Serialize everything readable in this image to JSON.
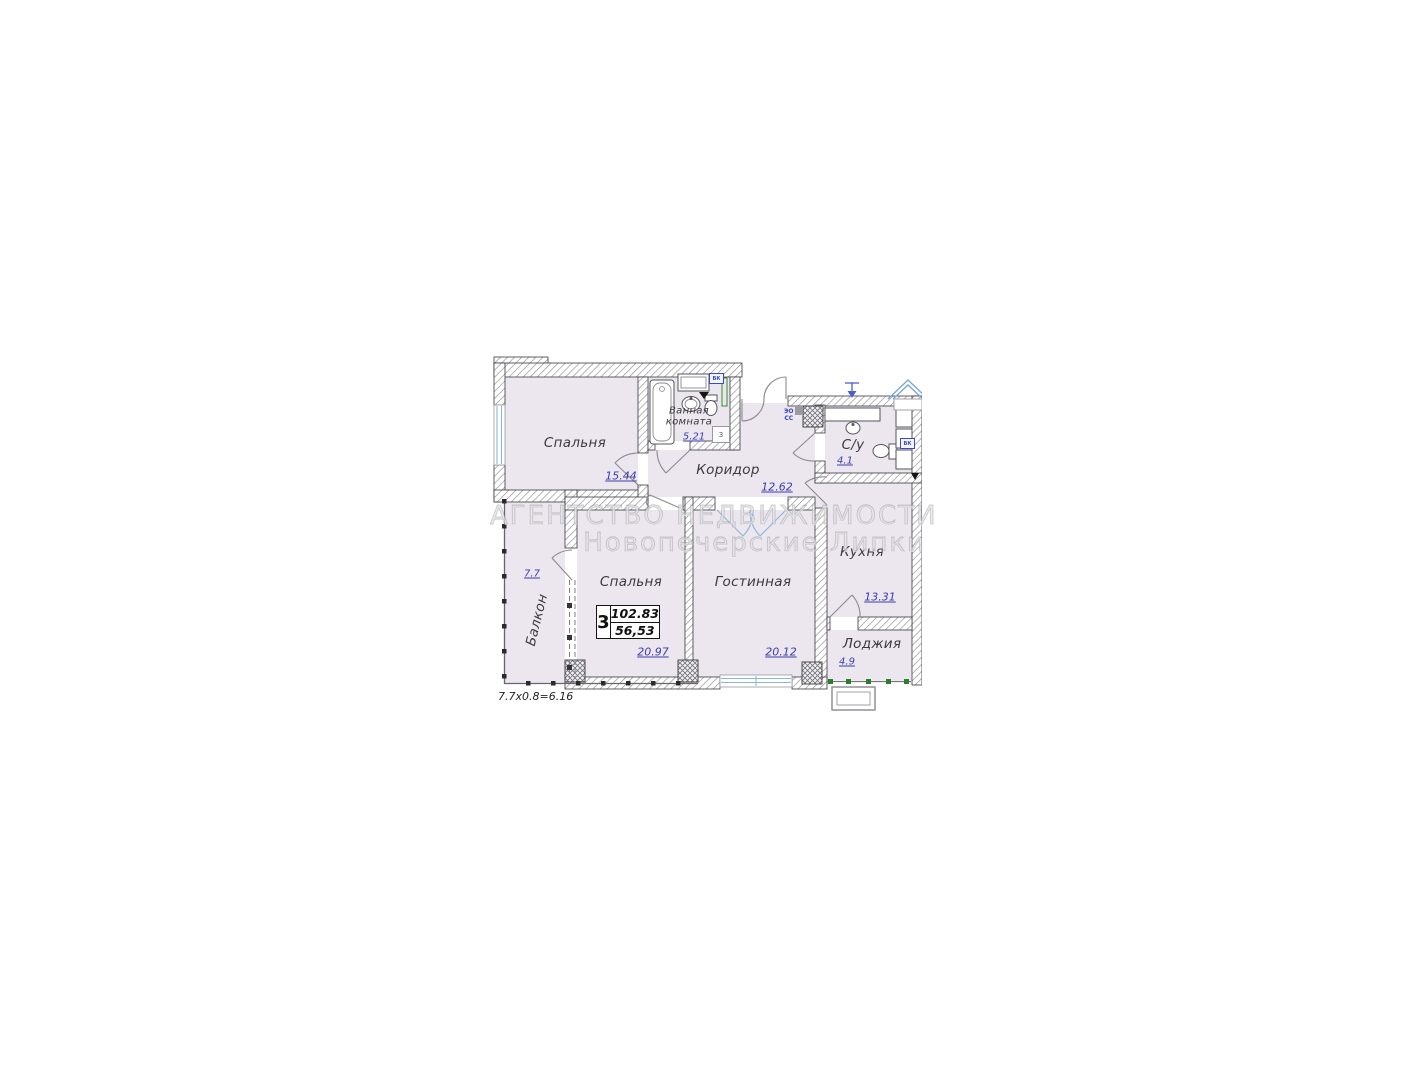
{
  "watermark": {
    "line1": "АГЕНТСТВО НЕДВИЖИМОСТИ",
    "line2": "Новопечерские Липки"
  },
  "info_box": {
    "rooms_count": "3",
    "area_total": "102.83",
    "area_living": "56,53"
  },
  "rooms": {
    "bedroom_top": {
      "label": "Спальня",
      "area": "15.44"
    },
    "bathroom": {
      "label_line1": "Ванная",
      "label_line2": "комната",
      "area": "5.21",
      "marker": "3"
    },
    "corridor": {
      "label": "Коридор",
      "area": "12.62"
    },
    "wc": {
      "label": "С/у",
      "area": "4.1"
    },
    "kitchen": {
      "label": "Кухня",
      "area": "13.31"
    },
    "loggia": {
      "label": "Лоджия",
      "area": "4.9"
    },
    "bedroom_main": {
      "label": "Спальня",
      "area": "20.97"
    },
    "living_room": {
      "label": "Гостинная",
      "area": "20.12"
    },
    "balcony": {
      "label": "Балкон",
      "area": "7.7"
    }
  },
  "notes": {
    "balcony_calc": "7.7x0.8=6.16"
  },
  "markers": {
    "riser_line1": "ЭО",
    "riser_line2": "СС",
    "vk_bathroom": "ВК",
    "vk_wc": "ВК"
  },
  "colors": {
    "room_fill": "#ece6ee",
    "area_text": "#3c3cae",
    "window_blue": "#8ab6d8",
    "door_blue": "#90b8dc",
    "railing_green": "#2e7d2e",
    "wall_outline": "#3a3a3e"
  }
}
